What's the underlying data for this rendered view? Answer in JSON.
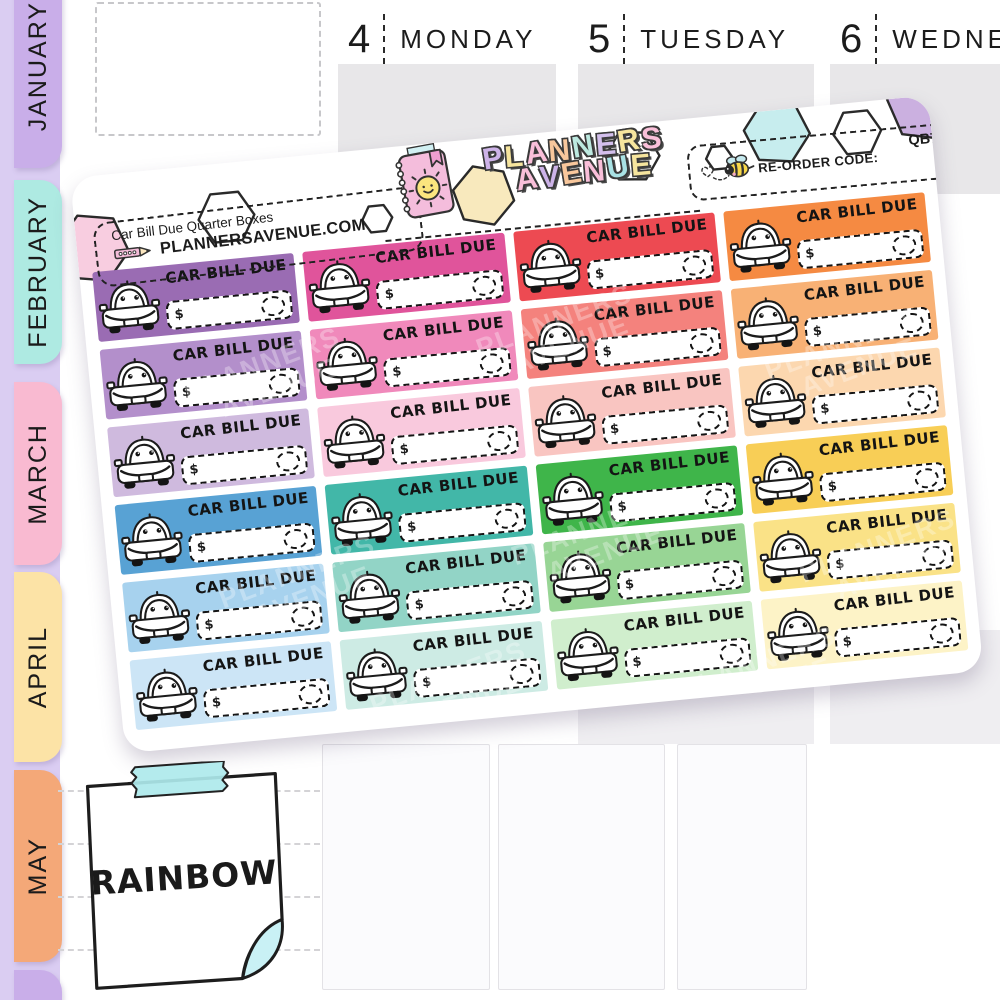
{
  "sidebar": {
    "strip_color": "#dacdf2",
    "tabs": [
      {
        "label": "JANUARY",
        "color": "#c9aee9"
      },
      {
        "label": "FEBRUARY",
        "color": "#aeeae2"
      },
      {
        "label": "MARCH",
        "color": "#f9bad1"
      },
      {
        "label": "APRIL",
        "color": "#fce3a6"
      },
      {
        "label": "MAY",
        "color": "#f4a878"
      },
      {
        "label": "",
        "color": "#c9aee9"
      }
    ]
  },
  "calendar": {
    "box_color": "#e8e7e9",
    "days": [
      {
        "number": "4",
        "name": "MONDAY"
      },
      {
        "number": "5",
        "name": "TUESDAY"
      },
      {
        "number": "6",
        "name": "WEDNE"
      }
    ]
  },
  "sheet": {
    "product_title": "Car Bill Due Quarter Boxes",
    "website": "PLANNERSAVENUE.COM",
    "reorder_label": "RE-ORDER CODE:",
    "reorder_code": "QB73",
    "logo": {
      "line1_letters": [
        "P",
        "L",
        "A",
        "N",
        "N",
        "E",
        "R",
        "S"
      ],
      "line1_colors": [
        "#cdb3e8",
        "#f6e59e",
        "#f9bfd9",
        "#f8c79c",
        "#bde9e0",
        "#d3bfec",
        "#f6e59e",
        "#f9bfd9"
      ],
      "line2_letters": [
        "A",
        "V",
        "E",
        "N",
        "U",
        "E"
      ],
      "line2_colors": [
        "#f9bfd9",
        "#cdb3e8",
        "#f8c79c",
        "#f9bfd9",
        "#a9e2e4",
        "#f6e59e"
      ]
    },
    "hex_fills": [
      "#f8cde0",
      "#ffffff",
      "#ffffff",
      "#f8e9bd",
      "#ffffff",
      "#ffffff",
      "#c7edee",
      "#ffffff",
      "#cbb0e0"
    ],
    "watermark_line1": "PLANNERS",
    "watermark_line2": "AVENUE",
    "sticker_label": "CAR BILL DUE",
    "currency": "$",
    "sticker_colors": [
      "#9a6cb3",
      "#e0549b",
      "#ed4a52",
      "#f58a42",
      "#b38fcb",
      "#f089bb",
      "#f4827d",
      "#f8b175",
      "#cfbade",
      "#f9c9dd",
      "#f9c5c1",
      "#fcd7af",
      "#58a2d4",
      "#42b7a8",
      "#3fb54a",
      "#f8ce56",
      "#a7d2ee",
      "#92d4c6",
      "#98d595",
      "#fae287",
      "#cce5f6",
      "#cdebe4",
      "#d0eecd",
      "#fdf3c7"
    ]
  },
  "note": {
    "text": "RAINBOW",
    "tape_color": "#aee9ec",
    "curl_color": "#c9f1f5"
  },
  "icons": {
    "car": "car-icon",
    "pencil": "pencil-icon",
    "bee": "bee-icon",
    "notebook_sun": "notebook-sun-icon",
    "hexagons": "hexagon-confetti-icons"
  }
}
